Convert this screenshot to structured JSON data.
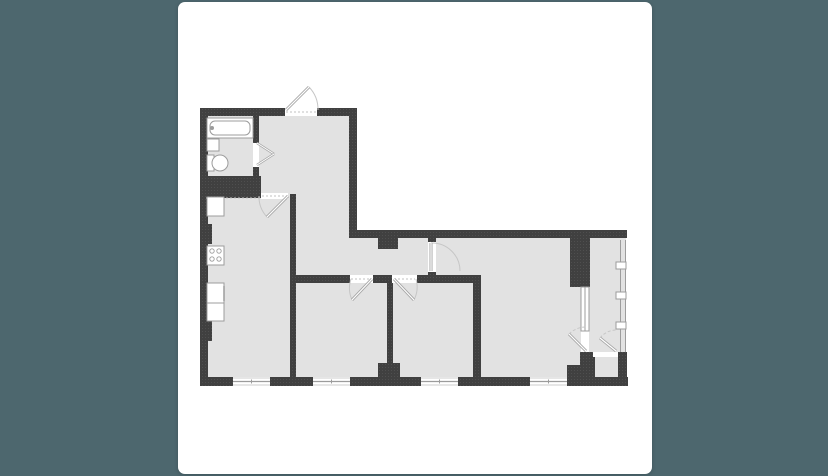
{
  "page": {
    "background": "#4d676e"
  },
  "card": {
    "background": "#ffffff",
    "x": 178,
    "y": 2,
    "width": 474,
    "height": 472,
    "radius": 7
  },
  "plan": {
    "viewBox": "178 2 474 472",
    "colors": {
      "wall": "#404040",
      "wall_dot": "#525252",
      "room": "#e2e2e2",
      "opening": "#ffffff",
      "fixture_fill": "#ffffff",
      "fixture_stroke": "#9c9c9c",
      "door_leaf": "#a6a6a6",
      "door_leaf_core": "#ffffff",
      "door_arc": "#c6c6c6",
      "window_line": "#9c9c9c",
      "window_edge": "#cccccc",
      "threshold": "#c2c2c2"
    },
    "rooms_depicted": [
      "bathroom",
      "hallway",
      "kitchen",
      "bedroom-1",
      "bedroom-2",
      "living-room",
      "balcony"
    ],
    "outline": [
      [
        204,
        112
      ],
      [
        353,
        112
      ],
      [
        353,
        234
      ],
      [
        626,
        234
      ],
      [
        626,
        382
      ],
      [
        204,
        382
      ]
    ],
    "walls": [
      [
        200,
        108,
        85,
        8
      ],
      [
        317,
        108,
        40,
        8
      ],
      [
        200,
        108,
        8,
        277
      ],
      [
        200,
        224,
        12,
        20
      ],
      [
        200,
        321,
        12,
        20
      ],
      [
        349,
        108,
        8,
        130
      ],
      [
        349,
        230,
        278,
        8
      ],
      [
        253,
        116,
        6,
        27
      ],
      [
        253,
        165,
        6,
        12
      ],
      [
        290,
        194,
        6,
        183
      ],
      [
        296,
        275,
        54,
        8
      ],
      [
        373,
        275,
        19,
        8
      ],
      [
        417,
        275,
        63,
        8
      ],
      [
        387,
        283,
        6,
        80
      ],
      [
        378,
        363,
        22,
        14
      ],
      [
        473,
        275,
        8,
        102
      ],
      [
        428,
        234,
        8,
        8
      ],
      [
        428,
        272,
        8,
        11
      ],
      [
        378,
        238,
        20,
        11
      ],
      [
        570,
        238,
        20,
        49
      ],
      [
        580,
        352,
        15,
        33
      ],
      [
        567,
        365,
        13,
        21
      ],
      [
        618,
        352,
        9,
        33
      ],
      [
        200,
        377,
        33,
        9
      ],
      [
        270,
        377,
        43,
        9
      ],
      [
        350,
        377,
        71,
        9
      ],
      [
        458,
        377,
        72,
        9
      ],
      [
        567,
        377,
        61,
        9
      ]
    ],
    "shaft": [
      204,
      176,
      57,
      22
    ],
    "white_openings": [
      [
        285,
        108,
        32,
        8
      ],
      [
        253,
        143,
        6,
        24
      ],
      [
        261,
        193,
        27,
        6
      ],
      [
        350,
        275,
        23,
        8
      ],
      [
        392,
        275,
        25,
        8
      ],
      [
        428,
        242,
        8,
        30
      ],
      [
        581,
        331,
        8,
        21
      ],
      [
        593,
        352,
        25,
        5
      ]
    ],
    "thresholds": [
      [
        286,
        112,
        316,
        112
      ],
      [
        262,
        196,
        288,
        196
      ],
      [
        351,
        279,
        371,
        279
      ],
      [
        394,
        279,
        415,
        279
      ],
      [
        431,
        245,
        431,
        269
      ],
      [
        206,
        198,
        260,
        198
      ]
    ],
    "bottom_windows": [
      [
        233,
        377,
        37,
        9
      ],
      [
        313,
        377,
        37,
        9
      ],
      [
        421,
        377,
        37,
        9
      ],
      [
        530,
        377,
        37,
        9
      ]
    ],
    "glazing": {
      "x1": 620.5,
      "x2": 625.5,
      "y1": 240,
      "y2": 352,
      "mullions": [
        [
          616,
          262,
          10,
          7
        ],
        [
          616,
          292,
          10,
          7
        ],
        [
          616,
          322,
          10,
          7
        ]
      ]
    },
    "inner_window": [
      581,
      287,
      8,
      44
    ],
    "doors": [
      {
        "name": "entrance-door",
        "hinge": [
          286,
          110
        ],
        "tip": [
          309,
          87
        ],
        "jamb": [
          318,
          110
        ],
        "sweep": 1,
        "dashed": false
      },
      {
        "name": "kitchen-door",
        "hinge": [
          288,
          196
        ],
        "tip": [
          267,
          217
        ],
        "jamb": [
          259,
          196
        ],
        "sweep": 1,
        "dashed": false
      },
      {
        "name": "bedroom-1-door",
        "hinge": [
          372,
          279
        ],
        "tip": [
          352,
          300
        ],
        "jamb": [
          351,
          279
        ],
        "sweep": 1,
        "dashed": false
      },
      {
        "name": "bedroom-2-door",
        "hinge": [
          394,
          279
        ],
        "tip": [
          414,
          300
        ],
        "jamb": [
          416,
          279
        ],
        "sweep": 0,
        "dashed": false
      },
      {
        "name": "living-room-door",
        "hinge": [
          431,
          271
        ],
        "tip": [
          431,
          243
        ],
        "jamb": [
          460,
          271
        ],
        "sweep": 1,
        "dashed": false
      },
      {
        "name": "balcony-door",
        "hinge": [
          586,
          351
        ],
        "tip": [
          569,
          334
        ],
        "jamb": [
          586,
          327
        ],
        "sweep": 1,
        "dashed": true
      },
      {
        "name": "balcony-partition-door",
        "hinge": [
          616,
          351
        ],
        "tip": [
          600,
          338
        ],
        "jamb": [
          616,
          330
        ],
        "sweep": 1,
        "dashed": true
      }
    ],
    "bathroom_door_lines": [
      [
        257,
        143,
        274,
        154
      ],
      [
        257,
        165,
        274,
        154
      ]
    ],
    "bathtub": {
      "outer": [
        207,
        118,
        46,
        20
      ],
      "inner": [
        210,
        121,
        40,
        14
      ],
      "faucet": [
        212,
        128,
        2
      ]
    },
    "sink": [
      207,
      139,
      12,
      12
    ],
    "toilet": {
      "tank": [
        207,
        155,
        7,
        16
      ],
      "bowl": [
        212,
        155,
        16,
        16
      ]
    },
    "kitchen_counter": {
      "boxes": [
        [
          207,
          197,
          17,
          19
        ],
        [
          207,
          283,
          17,
          20
        ],
        [
          207,
          303,
          17,
          18
        ]
      ],
      "stove": [
        207,
        246,
        17,
        19
      ],
      "burners": [
        [
          212,
          251
        ],
        [
          219,
          251
        ],
        [
          212,
          259
        ],
        [
          219,
          259
        ]
      ],
      "handle_tick": [
        224,
        286,
        224,
        301
      ]
    }
  }
}
